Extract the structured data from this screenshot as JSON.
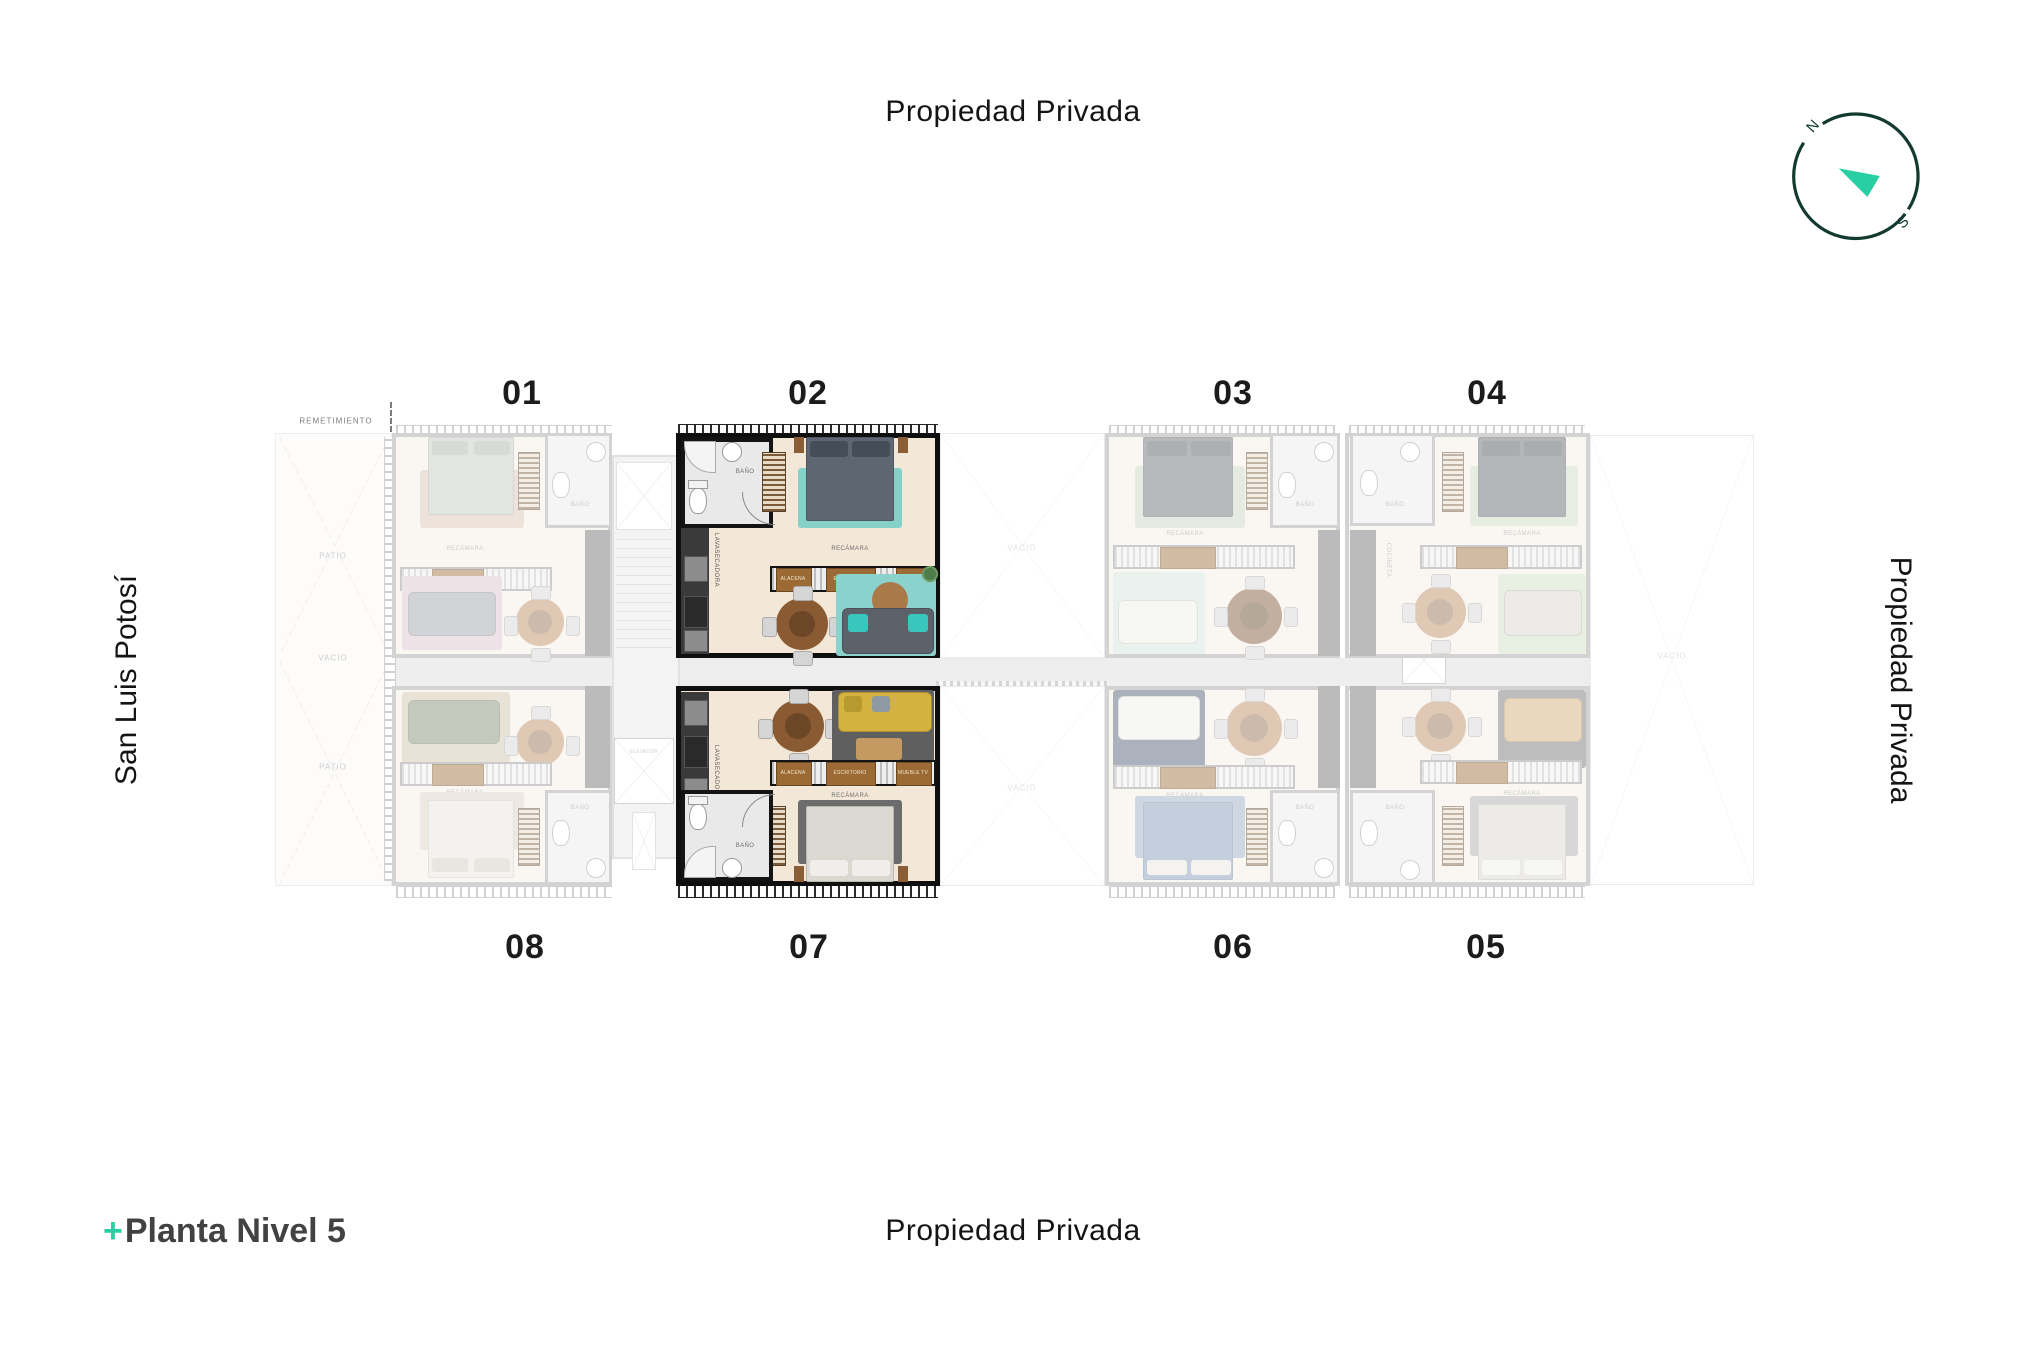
{
  "title": {
    "prefix": "+",
    "text": "Planta Nivel 5"
  },
  "boundaries": {
    "top": "Propiedad Privada",
    "bottom": "Propiedad Privada",
    "left": "San Luis Potosí",
    "right": "Propiedad Privada"
  },
  "compass": {
    "north": "N",
    "south": "S"
  },
  "units": {
    "top_row": [
      "01",
      "02",
      "03",
      "04"
    ],
    "bottom_row": [
      "08",
      "07",
      "06",
      "05"
    ],
    "highlighted": [
      "02",
      "07"
    ]
  },
  "plan": {
    "remetimiento": "REMETIMIENTO",
    "labels": {
      "patio": "PATIO",
      "vacio": "VACIO",
      "elevador": "ELEVADOR",
      "recamara": "RECÁMARA",
      "bano": "BAÑO",
      "cocineta": "COCINETA",
      "lavasecadora": "LAVASECADORA",
      "alacena": "ALACENA",
      "escritorio": "ESCRITORIO",
      "mueble_tv": "MUEBLE TV"
    }
  },
  "colors": {
    "accent_teal": "#27cfa2",
    "compass_ring": "#123a30",
    "highlight_wall": "#0f0f0f",
    "faded_wall": "#9f9f9f",
    "corridor": "#dadada",
    "ink": "#161616"
  }
}
